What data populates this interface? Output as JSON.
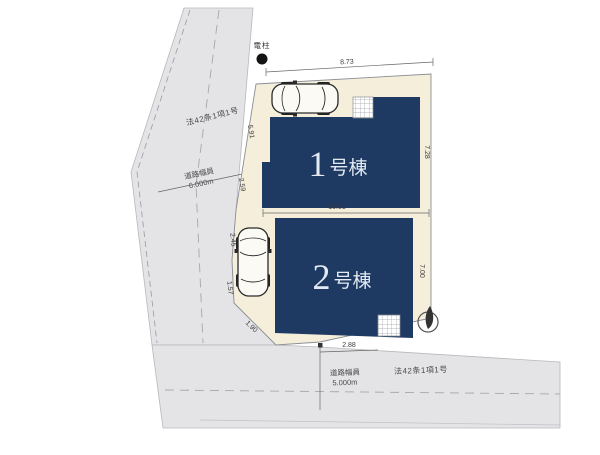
{
  "plan": {
    "buildings": [
      {
        "number": "1",
        "suffix": "号棟",
        "label": "1号棟"
      },
      {
        "number": "2",
        "suffix": "号棟",
        "label": "2号棟"
      }
    ],
    "landmarks": {
      "utility_pole": "電柱"
    },
    "roads": {
      "left": {
        "classification": "法42条1項1号",
        "width_label": "道路幅員",
        "width_value": "6.000m"
      },
      "bottom": {
        "classification": "法42条1項1号",
        "width_label": "道路幅員",
        "width_value": "5.000m"
      }
    },
    "dimensions": {
      "top": "8.73",
      "left_upper": "5.91",
      "left_lower": "2.59",
      "between": "10.01",
      "b1_right": "7.28",
      "b2_right": "7.00",
      "b2_left_upper": "2.45",
      "b2_left_lower": "1.57",
      "bottom_diagonal": "1.90",
      "bottom_offset": "2.88"
    },
    "icons": {
      "north_arrow": "north-arrow-icon",
      "utility_pole": "utility-pole-icon",
      "cars": "car-top-view-icon"
    },
    "colors": {
      "building": "#1e3a63",
      "lot": "#f4eedb",
      "road": "#e4e4e7",
      "building_text": "#e3eaf2"
    }
  }
}
